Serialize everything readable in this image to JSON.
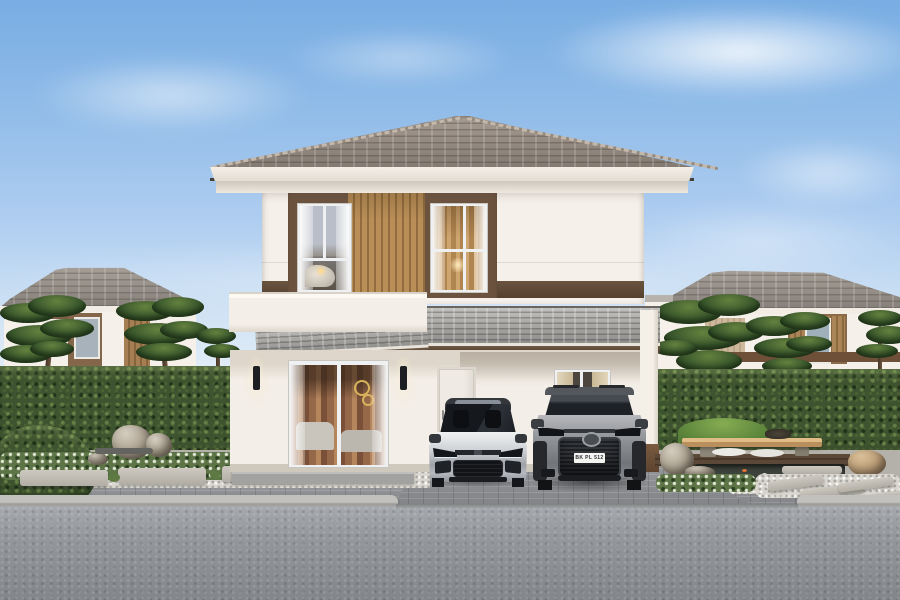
{
  "scene": {
    "subject": "two-storey detached house exterior with two cars parked under front carport",
    "suv": {
      "license_plate": "BK PL 512"
    },
    "palette": {
      "sky_top": "#79ade3",
      "sky_horizon": "#eef4f9",
      "main_roof_tile": "#8a8178",
      "awning_roof_tile": "#a2a19e",
      "wall_white": "#f5f1ea",
      "accent_band_brown": "#5e4936",
      "wood_slat": "#b78b55",
      "hedge_green": "#3e532f",
      "pine_green": "#3b592d",
      "grass_green": "#6f9a47",
      "bench_wood": "#d4ac76",
      "gravel_white": "#dad7d0",
      "paver_gray": "#8e9093",
      "curb_gray": "#b7b6b2",
      "road_asphalt": "#909397",
      "sedan_silver": "#c8cbd0",
      "suv_gray": "#8e9195",
      "warm_interior_glow": "#c49a64"
    }
  }
}
